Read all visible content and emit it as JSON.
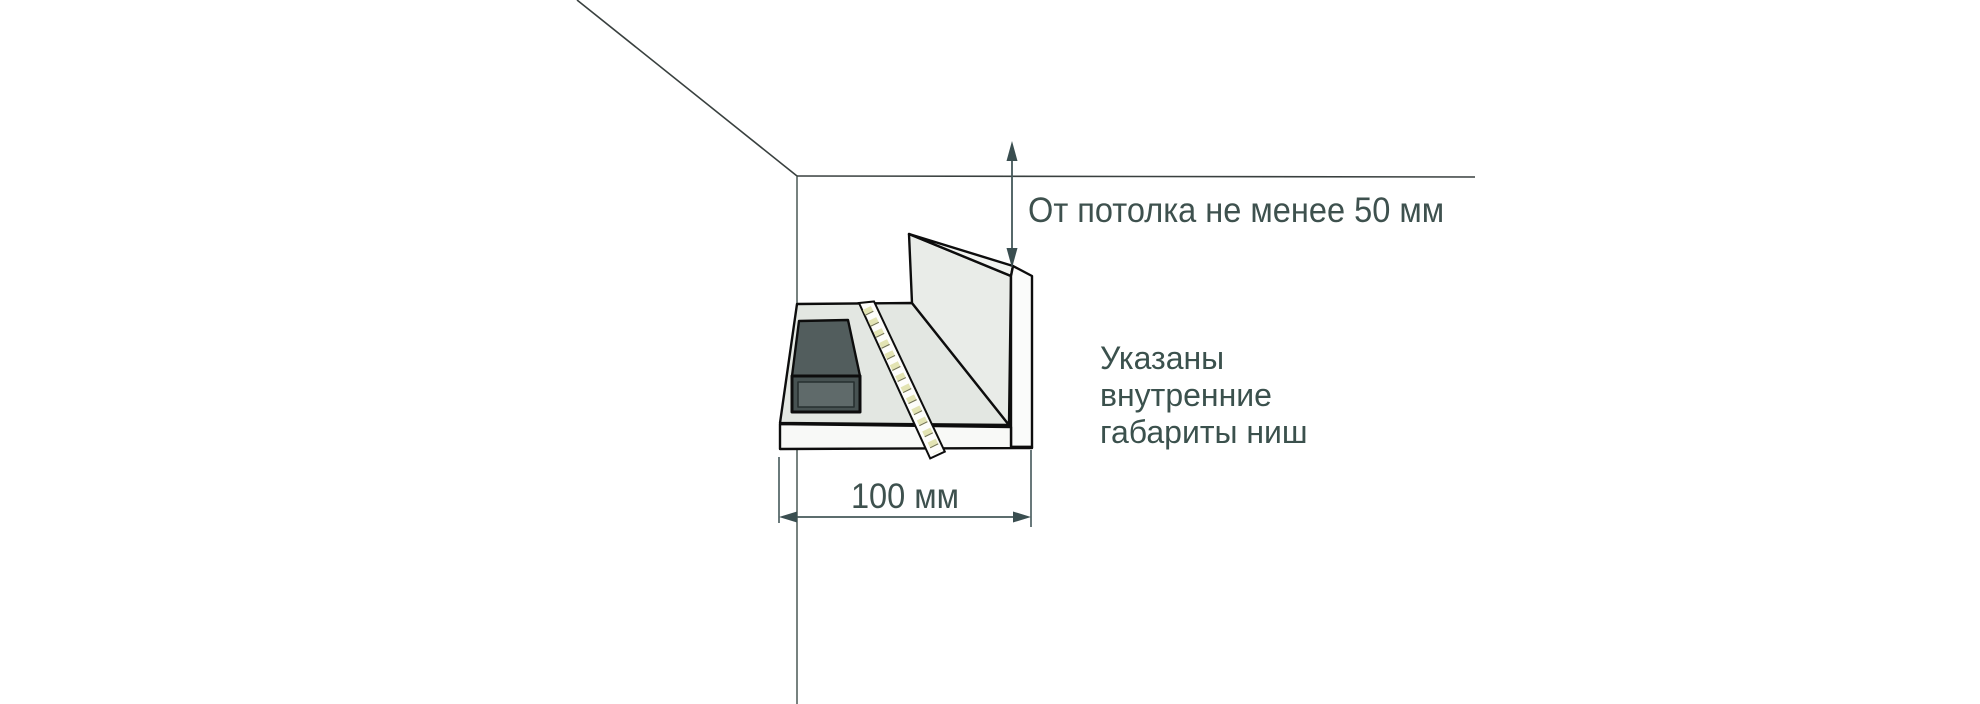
{
  "diagram": {
    "type": "installation-drawing",
    "subject": "ceiling niche cross-section with LED strip and power supply",
    "dimensions": {
      "vertical": {
        "label": "От потолка не менее 50 мм"
      },
      "horizontal": {
        "label": "100 мм"
      }
    },
    "note": {
      "text": "Указаны\nвнутренние\nгабариты ниш",
      "lines": [
        "Указаны",
        "внутренние",
        "габариты ниш"
      ]
    },
    "icons": [
      "arrow-up-icon",
      "arrow-down-icon",
      "arrow-left-icon",
      "arrow-right-icon"
    ],
    "colors": {
      "background": "#ffffff",
      "text": "#3e514e",
      "dimension_lines": "#44585a",
      "room_lines": "#39403f",
      "niche_outline": "#0d0d0d",
      "niche_surface": "#e3e7e2",
      "niche_panel": "#e9ece8",
      "niche_cut_face": "#fafbfa",
      "power_supply_top": "#525d5d",
      "power_supply_front": "#5f6a6a",
      "led_chip": "#e3e4b4"
    }
  }
}
